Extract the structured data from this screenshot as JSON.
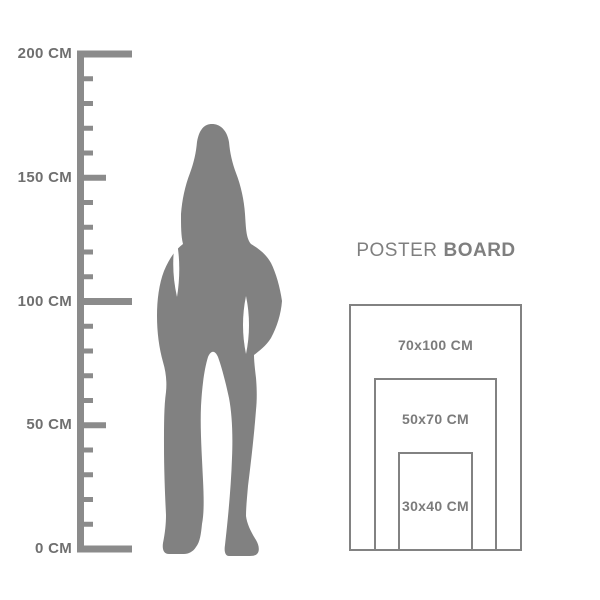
{
  "title": {
    "regular": "POSTER",
    "bold": "BOARD"
  },
  "ruler": {
    "unit": "CM",
    "min_cm": 0,
    "max_cm": 200,
    "minor_step_cm": 10,
    "labels": [
      {
        "cm": 200,
        "text": "200 CM"
      },
      {
        "cm": 150,
        "text": "150 CM"
      },
      {
        "cm": 100,
        "text": "100 CM"
      },
      {
        "cm": 50,
        "text": "50 CM"
      },
      {
        "cm": 0,
        "text": "0 CM"
      }
    ]
  },
  "figure": {
    "icon": "woman-silhouette"
  },
  "poster_sizes": [
    {
      "label": "70x100 CM",
      "width_cm": 70,
      "height_cm": 100
    },
    {
      "label": "50x70 CM",
      "width_cm": 50,
      "height_cm": 70
    },
    {
      "label": "30x40 CM",
      "width_cm": 30,
      "height_cm": 40
    }
  ],
  "colors": {
    "background": "#ffffff",
    "ruler": "#8b8b8b",
    "silhouette": "#818181",
    "ruler_label_text": "#6f6f6f",
    "poster_border": "#828282",
    "poster_label_text": "#7b7b7b",
    "title_text": "#7f7f7f"
  }
}
